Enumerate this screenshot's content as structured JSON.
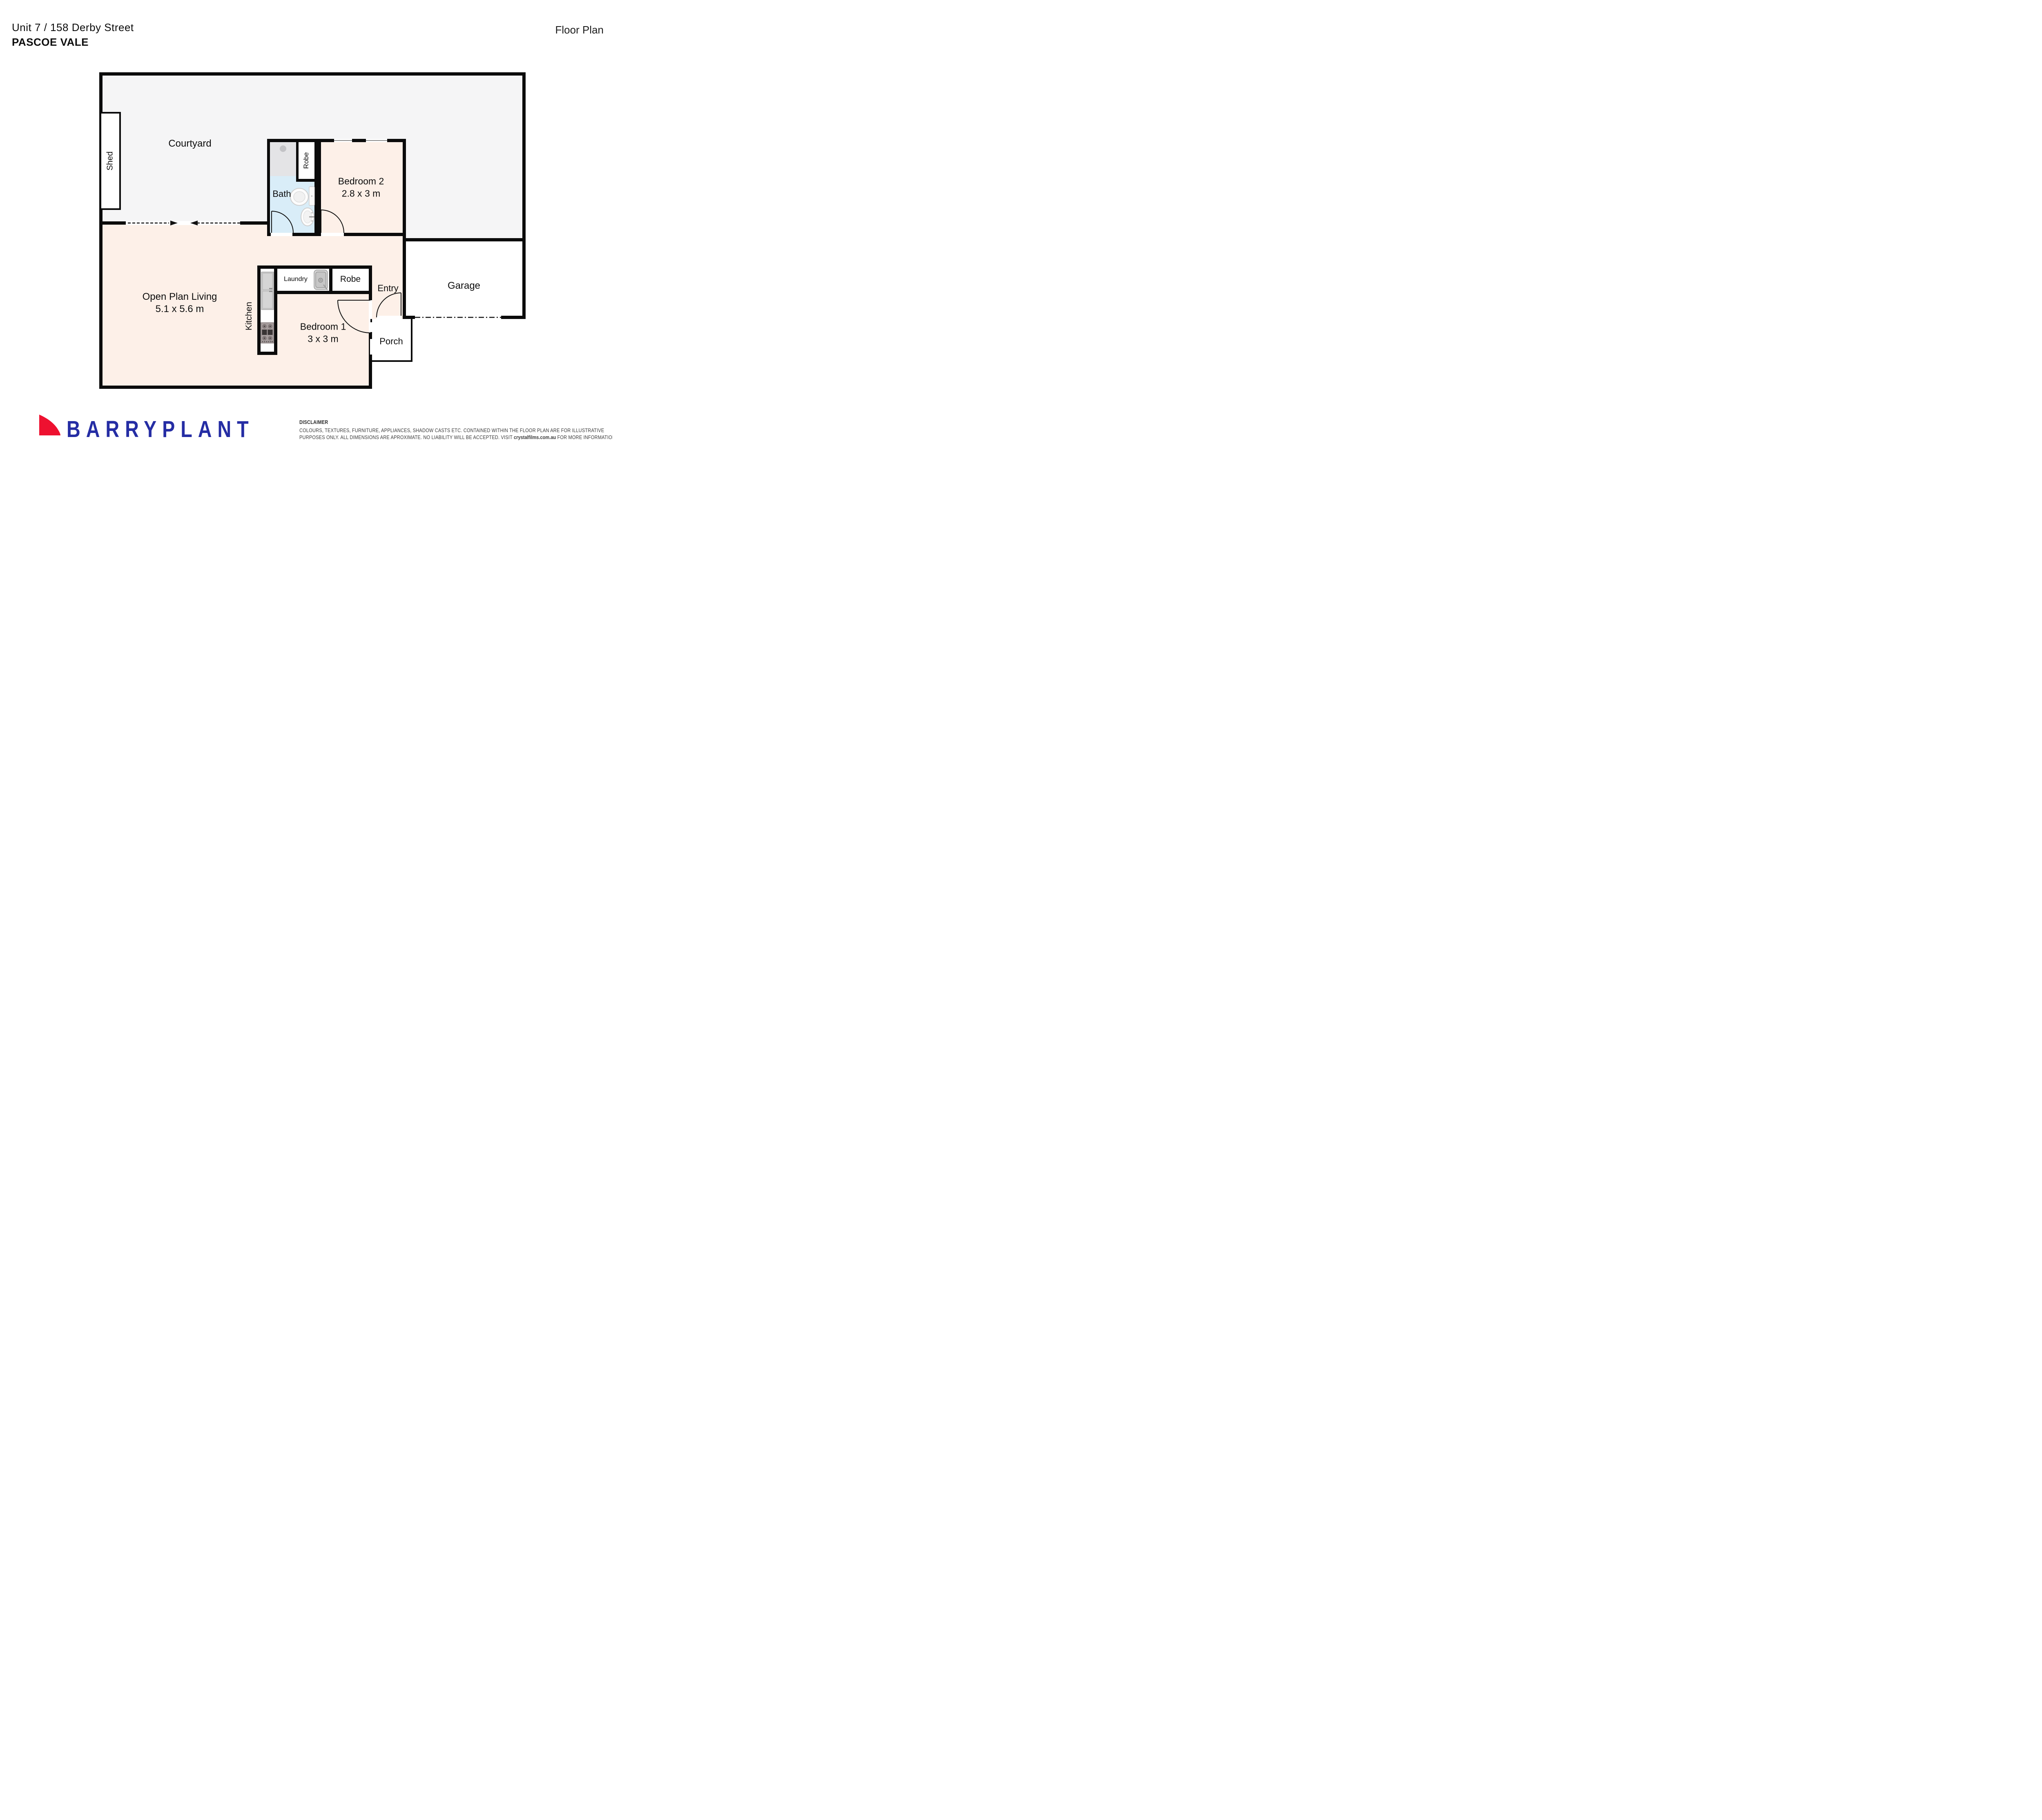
{
  "header": {
    "address_line1": "Unit 7 / 158 Derby Street",
    "address_line2": "PASCOE VALE",
    "page_label": "Floor Plan"
  },
  "plan": {
    "rooms": {
      "courtyard": {
        "label": "Courtyard"
      },
      "shed": {
        "label": "Shed"
      },
      "bath": {
        "label": "Bath"
      },
      "robe_bath": {
        "label": "Robe"
      },
      "bedroom2": {
        "label": "Bedroom 2",
        "dims": "2.8 x 3 m"
      },
      "living": {
        "label": "Open Plan Living",
        "dims": "5.1 x 5.6 m"
      },
      "kitchen": {
        "label": "Kitchen"
      },
      "laundry": {
        "label": "Laundry"
      },
      "robe_hall": {
        "label": "Robe"
      },
      "bedroom1": {
        "label": "Bedroom 1",
        "dims": "3 x 3 m"
      },
      "entry": {
        "label": "Entry"
      },
      "garage": {
        "label": "Garage"
      },
      "porch": {
        "label": "Porch"
      }
    },
    "colors": {
      "wall": "#0b0b0b",
      "floor_pink": "#fdf0e8",
      "wet_blue": "#d9edf8",
      "outdoor_gray": "#f5f5f6",
      "shower_gray": "#e4e4e6"
    }
  },
  "footer": {
    "brand": "BARRYPLANT",
    "brand_colors": {
      "blue": "#252da4",
      "red": "#ee1130"
    },
    "disclaimer": {
      "title": "DISCLAIMER",
      "line1": "COLOURS, TEXTURES, FURNITURE, APPLIANCES, SHADOW CASTS ETC. CONTAINED WITHIN THE FLOOR PLAN ARE FOR ILLUSTRATIVE",
      "line2_pre": "PURPOSES ONLY. ALL DIMENSIONS ARE APROXIMATE. NO LIABILITY WILL BE ACCEPTED. VISIT ",
      "link": "crystalfilms.com.au",
      "line2_post": " FOR MORE INFORMATION"
    }
  }
}
